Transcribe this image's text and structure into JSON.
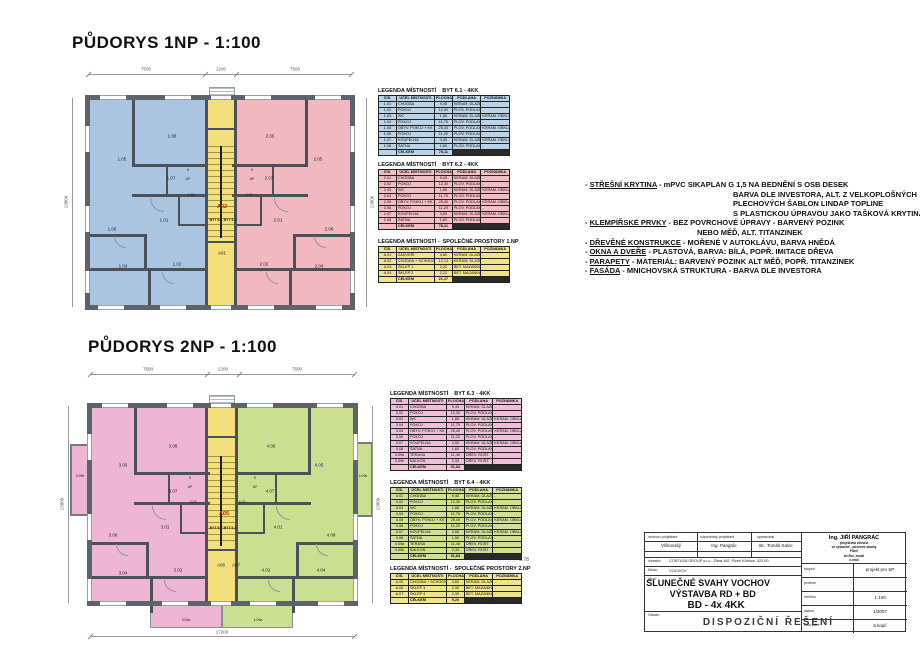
{
  "plan1": {
    "title": "PŮDORYS 1NP - 1:100",
    "dims": {
      "top_left": "7500",
      "top_center": "2200",
      "top_right": "7500",
      "left": "13800",
      "right": "13800"
    },
    "rooms": {
      "r101": "1.01",
      "r102": "1.02",
      "r103": "1.03",
      "r104": "1.04",
      "r105": "1.05",
      "r106": "1.06",
      "r107": "1.07",
      "r108": "1.08",
      "r201": "2.01",
      "r202": "2.02",
      "r203": "2.03",
      "r204": "2.04",
      "r205": "2.05",
      "r206": "2.06",
      "r207": "2.07",
      "r208": "2.08",
      "a01": "A01",
      "a02": "A02",
      "byt1": "BYT 6.1",
      "byt2": "BYT 6.2",
      "k": "K",
      "ap": "AP"
    }
  },
  "plan2": {
    "title": "PŮDORYS 2NP - 1:100",
    "dims": {
      "top_left": "7500",
      "top_center": "2200",
      "top_right": "7500",
      "left": "13800",
      "right": "13800",
      "bottom": "17200",
      "side_note": "6,78"
    },
    "rooms": {
      "r301": "3.01",
      "r302": "3.02",
      "r303": "3.03",
      "r304": "3.04",
      "r305": "3.05",
      "r306": "3.06",
      "r307": "3.07",
      "r308": "3.08",
      "r309a": "3.09a",
      "r309b": "3.09b",
      "r401": "4.01",
      "r402": "4.02",
      "r403": "4.03",
      "r404": "4.04",
      "r405": "4.05",
      "r406": "4.06",
      "r407": "4.07",
      "r408": "4.08",
      "r409a": "4.09a",
      "r409b": "4.09b",
      "a05": "A05",
      "a06": "A06",
      "a07": "A07",
      "byt3": "BYT 6.3",
      "byt4": "BYT 6.4",
      "k": "K",
      "ap": "AP"
    }
  },
  "legends": [
    {
      "title": "LEGENDA MÍSTNOSTÍ    BYT 6.1 - 4KK",
      "bg": "#b9d3e8",
      "headers": [
        "ČÍS.",
        "ÚČEL MÍSTNOSTI",
        "PLOCHA m²",
        "PODLAHA",
        "POZNÁMKA"
      ],
      "rows": [
        [
          "1.01",
          "CHODBA",
          "9,45",
          "KERAM. DLAŽBA",
          "-"
        ],
        [
          "1.02",
          "POKOJ",
          "12,30",
          "PLOV. PODLAHA",
          "-"
        ],
        [
          "1.03",
          "WC",
          "1,86",
          "KERAM. DLAŽBA",
          "KERAM. OBKLAD v=1500"
        ],
        [
          "1.04",
          "POKOJ",
          "11,75",
          "PLOV. PODLAHA",
          "-"
        ],
        [
          "1.05",
          "OBÝV. POKOJ + KK",
          "25,40",
          "PLOV. PODLAHA",
          "KERAM. OBKLAD - KUCH. KOUT"
        ],
        [
          "1.06",
          "POKOJ",
          "11,20",
          "PLOV. PODLAHA",
          "-"
        ],
        [
          "1.07",
          "KOUPELNA",
          "4,55",
          "KERAM. DLAŽBA",
          "KERAM. OBKLAD v=2000"
        ],
        [
          "1.08",
          "ŠATNA",
          "1,60",
          "PLOV. PODLAHA",
          "-"
        ]
      ],
      "total_label": "CELKEM",
      "total": "78,11"
    },
    {
      "title": "LEGENDA MÍSTNOSTÍ    BYT 6.2 - 4KK",
      "bg": "#f3bcc1",
      "headers": [
        "ČÍS.",
        "ÚČEL MÍSTNOSTI",
        "PLOCHA m²",
        "PODLAHA",
        "POZNÁMKA"
      ],
      "rows": [
        [
          "2.01",
          "CHODBA",
          "9,45",
          "KERAM. DLAŽBA",
          "-"
        ],
        [
          "2.02",
          "POKOJ",
          "12,30",
          "PLOV. PODLAHA",
          "-"
        ],
        [
          "2.03",
          "WC",
          "1,86",
          "KERAM. DLAŽBA",
          "KERAM. OBKLAD v=1500"
        ],
        [
          "2.04",
          "POKOJ",
          "11,75",
          "PLOV. PODLAHA",
          "-"
        ],
        [
          "2.05",
          "OBÝV. POKOJ + KK",
          "25,40",
          "PLOV. PODLAHA",
          "KERAM. OBKLAD - KUCH. KOUT"
        ],
        [
          "2.06",
          "POKOJ",
          "11,20",
          "PLOV. PODLAHA",
          "-"
        ],
        [
          "2.07",
          "KOUPELNA",
          "4,55",
          "KERAM. DLAŽBA",
          "KERAM. OBKLAD v=2000"
        ],
        [
          "2.08",
          "ŠATNA",
          "1,60",
          "PLOV. PODLAHA",
          "-"
        ]
      ],
      "total_label": "CELKEM",
      "total": "78,11"
    },
    {
      "title": "LEGENDA MÍSTNOSTÍ -  SPOLEČNÉ PROSTORY 1.NP",
      "bg": "#efe48e",
      "headers": [
        "ČÍS.",
        "ÚČEL MÍSTNOSTI",
        "PLOCHA m²",
        "PODLAHA",
        "POZNÁMKA"
      ],
      "rows": [
        [
          "A.01",
          "ZÁDVEŘÍ",
          "4,60",
          "KERAM. DLAŽBA",
          "-"
        ],
        [
          "A.02",
          "CHODBA + SCHODIŠTĚ",
          "12,13",
          "KERAM. DLAŽBA",
          "-"
        ],
        [
          "A.03",
          "SKLEP 1",
          "2,22",
          "BET. MAZANINA",
          "-"
        ],
        [
          "A.04",
          "SKLEP 2",
          "2,22",
          "BET. MAZANINA",
          "-"
        ]
      ],
      "total_label": "CELKEM",
      "total": "21,17"
    },
    {
      "title": "LEGENDA MÍSTNOSTÍ    BYT 6.3 - 4KK",
      "bg": "#eec0d8",
      "headers": [
        "ČÍS.",
        "ÚČEL MÍSTNOSTI",
        "PLOCHA m²",
        "PODLAHA",
        "POZNÁMKA"
      ],
      "rows": [
        [
          "3.01",
          "CHODBA",
          "9,45",
          "KERAM. DLAŽBA",
          "-"
        ],
        [
          "3.02",
          "POKOJ",
          "12,30",
          "PLOV. PODLAHA",
          "-"
        ],
        [
          "3.03",
          "WC",
          "1,86",
          "KERAM. DLAŽBA",
          "KERAM. OBKLAD v=1500"
        ],
        [
          "3.04",
          "POKOJ",
          "11,75",
          "PLOV. PODLAHA",
          "-"
        ],
        [
          "3.05",
          "OBÝV. POKOJ + KK",
          "25,40",
          "PLOV. PODLAHA",
          "KERAM. OBKLAD - KUCH. KOUT"
        ],
        [
          "3.06",
          "POKOJ",
          "11,20",
          "PLOV. PODLAHA",
          "-"
        ],
        [
          "3.07",
          "KOUPELNA",
          "4,55",
          "KERAM. DLAŽBA",
          "KERAM. OBKLAD v=2000"
        ],
        [
          "3.08",
          "ŠATNA",
          "1,60",
          "PLOV. PODLAHA",
          "-"
        ],
        [
          "3.09a",
          "TERASA",
          "11,40",
          "DŘEV. ROŠT",
          "-"
        ],
        [
          "3.09b",
          "BALKON",
          "2,33",
          "DŘEV. ROŠT",
          "-"
        ]
      ],
      "total_label": "CELKEM",
      "total": "91,84"
    },
    {
      "title": "LEGENDA MÍSTNOSTÍ    BYT 6.4 - 4KK",
      "bg": "#cfe093",
      "headers": [
        "ČÍS.",
        "ÚČEL MÍSTNOSTI",
        "PLOCHA m²",
        "PODLAHA",
        "POZNÁMKA"
      ],
      "rows": [
        [
          "4.01",
          "CHODBA",
          "9,45",
          "KERAM. DLAŽBA",
          "-"
        ],
        [
          "4.02",
          "POKOJ",
          "12,30",
          "PLOV. PODLAHA",
          "-"
        ],
        [
          "4.03",
          "WC",
          "1,86",
          "KERAM. DLAŽBA",
          "KERAM. OBKLAD v=1500"
        ],
        [
          "4.04",
          "POKOJ",
          "11,75",
          "PLOV. PODLAHA",
          "-"
        ],
        [
          "4.05",
          "OBÝV. POKOJ + KK",
          "25,40",
          "PLOV. PODLAHA",
          "KERAM. OBKLAD - KUCH. KOUT"
        ],
        [
          "4.06",
          "POKOJ",
          "11,20",
          "PLOV. PODLAHA",
          "-"
        ],
        [
          "4.07",
          "KOUPELNA",
          "4,55",
          "KERAM. DLAŽBA",
          "KERAM. OBKLAD v=2000"
        ],
        [
          "4.08",
          "ŠATNA",
          "1,60",
          "PLOV. PODLAHA",
          "-"
        ],
        [
          "4.09a",
          "TERASA",
          "11,40",
          "DŘEV. ROŠT",
          "-"
        ],
        [
          "4.09b",
          "BALKON",
          "2,33",
          "DŘEV. ROŠT",
          "-"
        ]
      ],
      "total_label": "CELKEM",
      "total": "91,84"
    },
    {
      "title": "LEGENDA MÍSTNOSTÍ -  SPOLEČNÉ PROSTORY 2.NP",
      "bg": "#efe48e",
      "headers": [
        "ČÍS.",
        "ÚČEL MÍSTNOSTI",
        "PLOCHA m²",
        "PODLAHA",
        "POZNÁMKA"
      ],
      "rows": [
        [
          "A.05",
          "CHODBA + SCHODIŠTĚ",
          "4,60",
          "KERAM. DLAŽBA",
          "-"
        ],
        [
          "A.06",
          "SKLEP 3",
          "2,30",
          "BET. MAZANINA",
          "-"
        ],
        [
          "A.07",
          "SKLEP 4",
          "2,30",
          "BET. MAZANINA",
          "-"
        ]
      ],
      "total_label": "CELKEM",
      "total": "9,20"
    }
  ],
  "notes": [
    {
      "lead": "STŘEŠNÍ KRYTINA",
      "text": " -  mPVC SIKAPLAN G 1,5 NA BEDNĚNÍ S OSB DESEK",
      "ind": 0
    },
    {
      "lead": "",
      "text": "BARVA DLE  INVESTORA,  ALT. Z VELKOPLOŠNÝCH",
      "ind": 2
    },
    {
      "lead": "",
      "text": "PLECHOVÝCH ŠABLON LINDAP TOPLINE",
      "ind": 2
    },
    {
      "lead": "",
      "text": "S PLASTICKOU ÚPRAVOU JAKO TAŠKOVÁ KRYTINA",
      "ind": 2
    },
    {
      "lead": "KLEMPÍŘSKÉ PRVKY",
      "text": " - BEZ POVRCHOVÉ ÚPRAVY - BARVENÝ POZINK",
      "ind": 0
    },
    {
      "lead": "",
      "text": "NEBO MĚĎ, ALT. TITANZINEK",
      "ind": 1
    },
    {
      "lead": "DŘEVĚNÉ KONSTRUKCE",
      "text": " -  MOŘENÉ V AUTOKLÁVU, BARVA HNĚDÁ",
      "ind": 0
    },
    {
      "lead": "OKNA A DVEŘE",
      "text": " - PLASTOVÁ, BARVA: BÍLÁ, POPŘ. IMITACE DŘEVA",
      "ind": 0
    },
    {
      "lead": "PARAPETY",
      "text": " - MATERIÁL: BARVENÝ POZINK ALT MĚĎ, POPŘ. TITANZINEK",
      "ind": 0
    },
    {
      "lead": "FASÁDA",
      "text": "  - MNICHOVSKÁ STRUKTURA - BARVA DLE INVESTORA",
      "ind": 0
    }
  ],
  "titleblock": {
    "col1_label": "vedoucí projektant",
    "col2_label": "odpovědný projektant",
    "col3_label": "vypracoval",
    "col1_value": "Vlčkovský",
    "col2_value": "Ing. Pangrác",
    "col3_value": "Bc. Tomáš Kaloc",
    "investor_label": "investor:",
    "investor_value": "CORTUSA GROUP s.r.o., Žitná 162, Plzeň Křimice, 322 00",
    "misto_label": "Místo:",
    "misto_value": "VOCHOV",
    "akce_label": "Akce:",
    "akce_line1": "SLUNEČNÉ SVAHY VOCHOV",
    "akce_line2": "VÝSTAVBA RD + BD",
    "akce_line3": "BD - 4x 4KK",
    "obsah_label": "Obsah:",
    "obsah_value": "DISPOZIČNÍ  ŘEŠENÍ",
    "firm_name": "Ing. JIŘÍ PANGRÁC",
    "firm_lines": [
      "projektová činnost",
      "ve výstavbě - pozemní stavby",
      "Plzeň",
      "tel./fax, mobil",
      "e-mail"
    ],
    "rows": [
      [
        "stupeň",
        "projekt pro SP"
      ],
      [
        "profese",
        ""
      ],
      [
        "měřítko",
        "1:100"
      ],
      [
        "datum",
        "1/2007"
      ],
      [
        "číslo paré",
        "6 kopií"
      ]
    ]
  }
}
